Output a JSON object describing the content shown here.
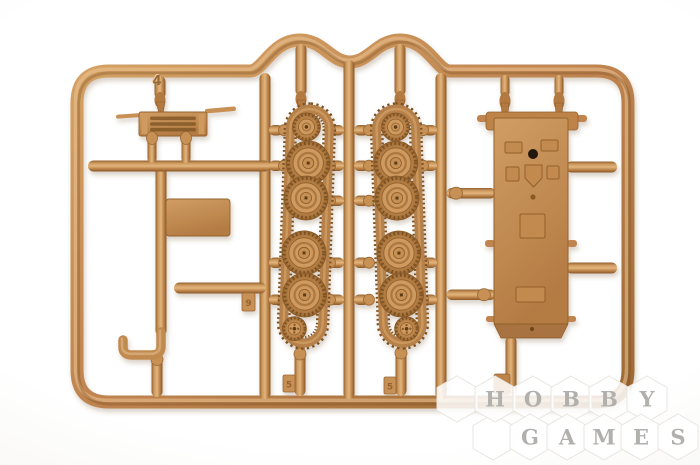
{
  "scene": {
    "description": "Photograph of a tan plastic model kit sprue (runner frame) holding tank parts: two track-and-wheel assemblies, a hull body, an engine grille, a flat plate, a rod and a tow hook, on a white background",
    "background_color": "#f7f5f2",
    "plastic_color": "#c08450",
    "plastic_highlight": "#e2b57d",
    "plastic_shadow": "#8a5a28"
  },
  "sprue": {
    "frame_mark": "4",
    "gate_tab_marks": [
      "9",
      "5",
      "5"
    ],
    "parts": {
      "grille": "engine-grille",
      "plate": "flat-plate",
      "hook": "tow-hook",
      "rod": "barrel-rod",
      "left_track": "track-run-with-wheels-left",
      "right_track": "track-run-with-wheels-right",
      "hull": "hull-body"
    }
  },
  "watermark": {
    "letter_color": "#b2b0ad",
    "hex_fill": "#ffffff",
    "rows": [
      {
        "letters": [
          "H",
          "O",
          "B",
          "B",
          "Y"
        ]
      },
      {
        "letters": [
          "G",
          "A",
          "M",
          "E",
          "S"
        ]
      }
    ]
  }
}
